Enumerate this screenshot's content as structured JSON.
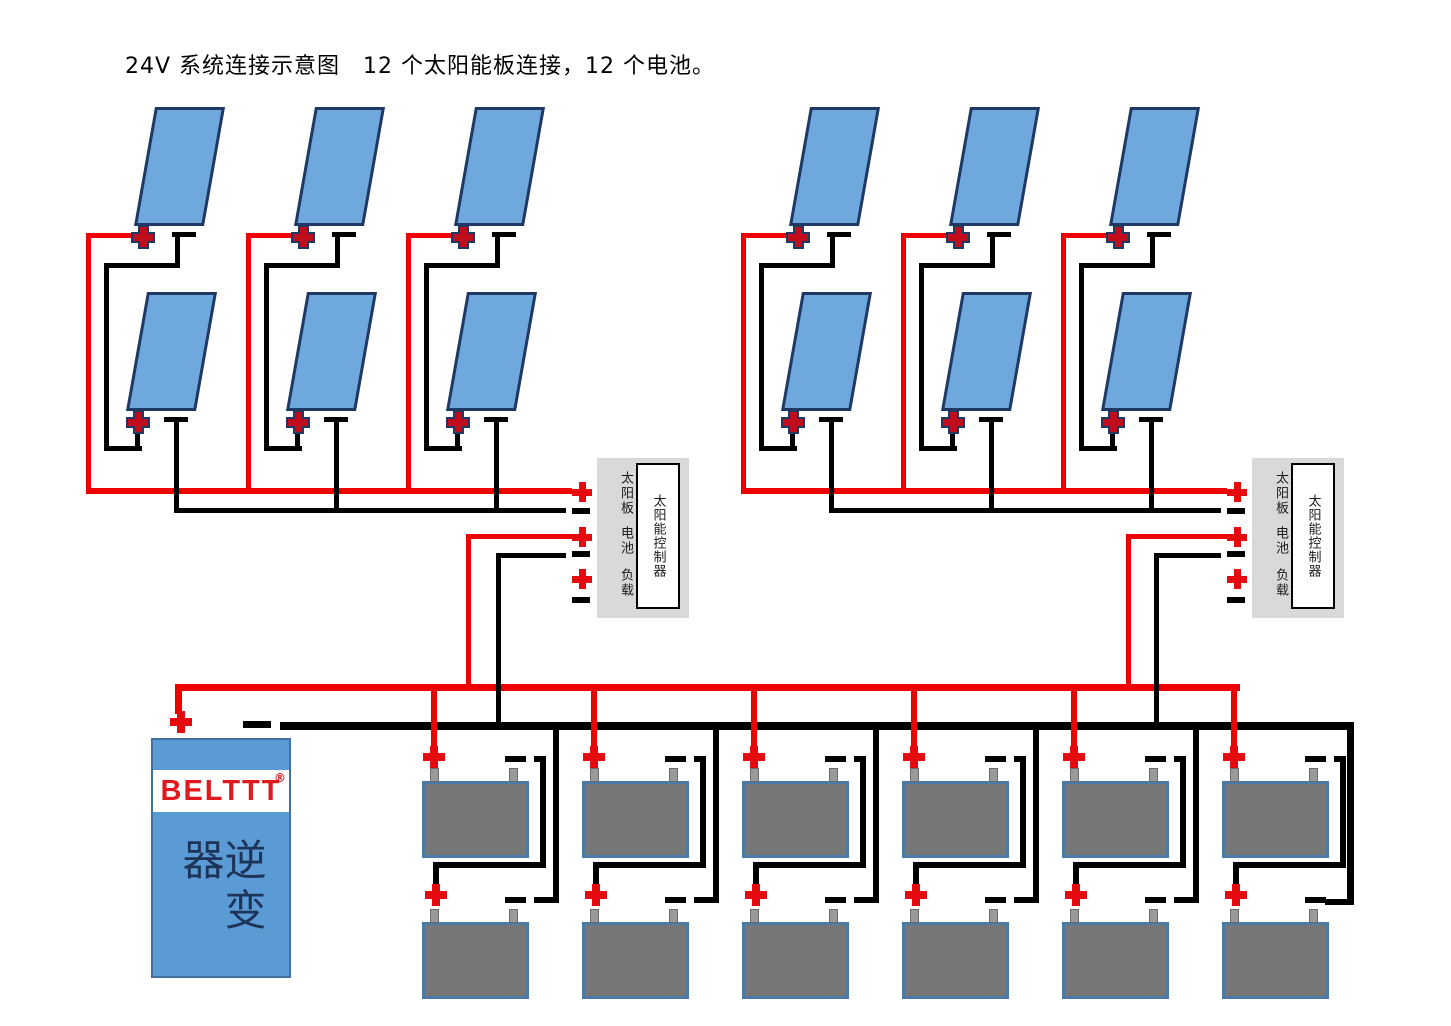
{
  "title": "24V 系统连接示意图　12 个太阳能板连接，12 个电池。",
  "system": {
    "voltage": "24V",
    "solar_panel_count": 12,
    "battery_count": 12,
    "controller_count": 2,
    "inverter_count": 1,
    "panels_per_string": 2,
    "batteries_per_string": 2
  },
  "controller": {
    "port_solar": "太阳板",
    "port_battery": "电池",
    "port_load": "负载",
    "name": "太阳能控制器"
  },
  "inverter": {
    "brand": "BELTTT",
    "trademark": "®",
    "name": "逆变器"
  },
  "colors": {
    "wire_positive": "#ee0000",
    "wire_negative": "#000000",
    "terminal_plus": "#e50a0f",
    "panel_plus": "#c00d1e",
    "panel_plus_outline": "#1f3864",
    "solar_panel": "#6fa8dc",
    "solar_panel_border": "#1f3864",
    "battery_body": "#777777",
    "battery_border": "#4a7ba6",
    "controller_bg": "#d9d9d9",
    "inverter_bg": "#5b9bd5",
    "brand_red": "#e0191e"
  }
}
